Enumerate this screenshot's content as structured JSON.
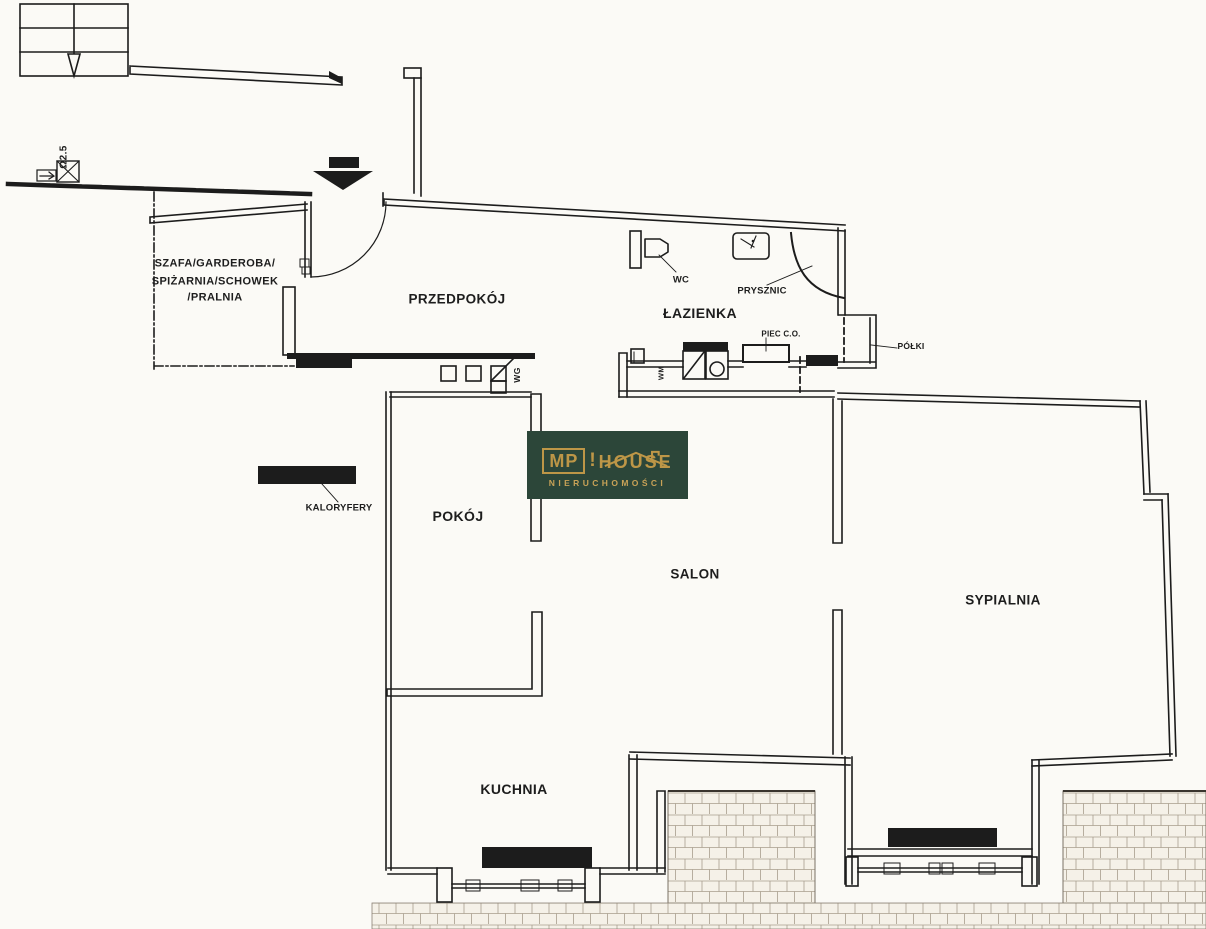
{
  "labels": {
    "storage1": "SZAFA/GARDEROBA/",
    "storage2": "SPIŻARNIA/SCHOWEK",
    "storage3": "/PRALNIA",
    "hallway": "PRZEDPOKÓJ",
    "bathroom": "ŁAZIENKA",
    "wc": "WC",
    "shower": "PRYSZNIC",
    "boiler": "PIEC C.O.",
    "shelves": "PÓŁKI",
    "vent_shaft": "WG",
    "washing_machine": "WM",
    "room": "POKÓJ",
    "living_room": "SALON",
    "bedroom": "SYPIALNIA",
    "kitchen": "KUCHNIA",
    "radiators_legend": "KALORYFERY",
    "height_mark": "Ω2.5"
  },
  "logo": {
    "mp": "MP",
    "separator": "!",
    "house": "HOUSE",
    "subtitle": "NIERUCHOMOŚCI"
  },
  "colors": {
    "paper": "#fbfaf6",
    "ink": "#1c1c1c",
    "logo_bg": "#2c4639",
    "logo_gold": "#bd9647",
    "brick_line": "#a89d8d"
  }
}
